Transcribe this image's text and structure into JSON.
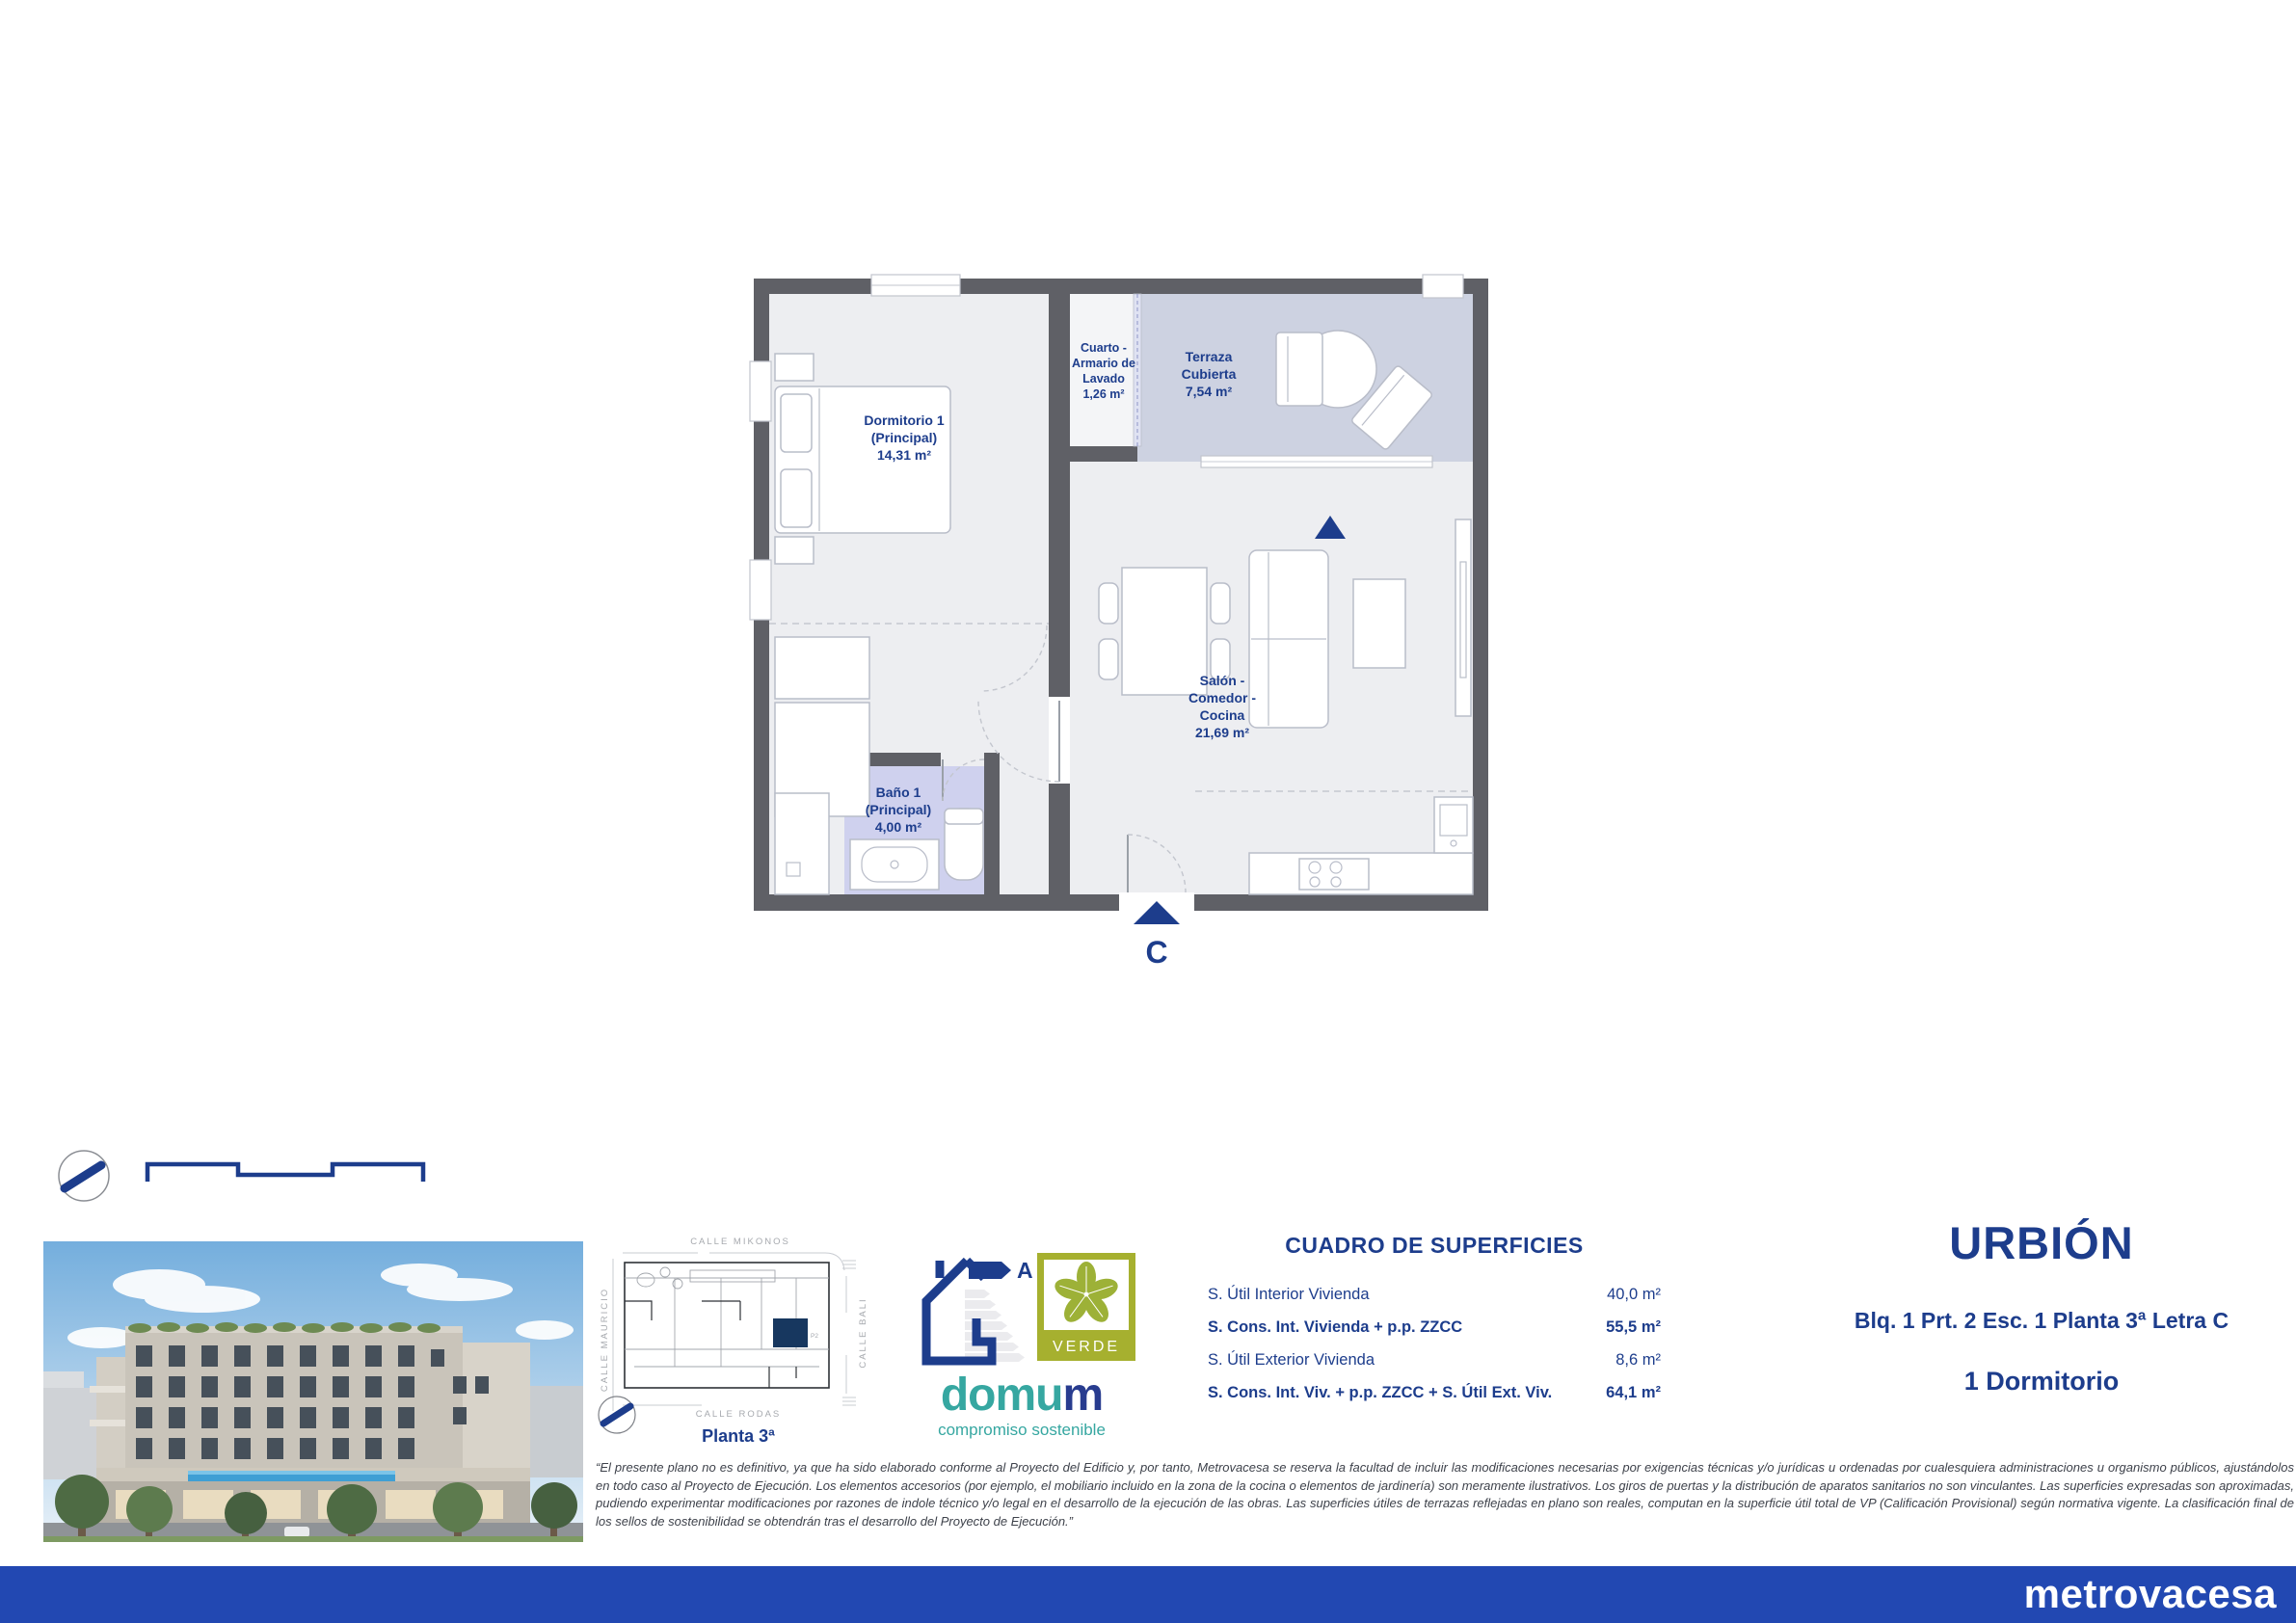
{
  "floor_plan": {
    "rooms": {
      "dormitorio": {
        "lines": [
          "Dormitorio 1",
          "(Principal)"
        ],
        "area": "14,31 m²"
      },
      "cuarto": {
        "lines": [
          "Cuarto -",
          "Armario de",
          "Lavado"
        ],
        "area": "1,26 m²"
      },
      "terraza": {
        "lines": [
          "Terraza",
          "Cubierta"
        ],
        "area": "7,54 m²"
      },
      "salon": {
        "lines": [
          "Salón -",
          "Comedor -",
          "Cocina"
        ],
        "area": "21,69 m²"
      },
      "bano": {
        "lines": [
          "Baño 1",
          "(Principal)"
        ],
        "area": "4,00 m²"
      }
    },
    "entrance_letter": "C"
  },
  "site_plan": {
    "streets": {
      "top": "CALLE MIKONOS",
      "left": "CALLE MAURICIO",
      "right": "CALLE BALI",
      "bottom": "CALLE RODAS"
    },
    "floor_label": "Planta 3ª",
    "unit_tag": "P2"
  },
  "energy": {
    "rating": "A"
  },
  "badges": {
    "verde": "VERDE",
    "domum_part1": "domu",
    "domum_part2": "m",
    "domum_tagline": "compromiso sostenible"
  },
  "surfaces": {
    "title": "CUADRO DE SUPERFICIES",
    "rows": [
      {
        "label": "S. Útil Interior Vivienda",
        "value": "40,0 m²"
      },
      {
        "label": "S. Cons. Int. Vivienda + p.p. ZZCC",
        "value": "55,5 m²"
      },
      {
        "label": "S. Útil Exterior Vivienda",
        "value": "8,6 m²"
      },
      {
        "label": "S. Cons. Int. Viv. + p.p. ZZCC + S. Útil Ext. Viv.",
        "value": "64,1 m²"
      }
    ]
  },
  "unit": {
    "project": "URBIÓN",
    "location": "Blq. 1 Prt. 2 Esc. 1 Planta 3ª Letra C",
    "type": "1 Dormitorio"
  },
  "disclaimer": "“El presente plano no es definitivo, ya que ha sido elaborado conforme al Proyecto del Edificio y, por tanto, Metrovacesa se reserva la facultad de incluir las modificaciones necesarias por exigencias técnicas y/o jurídicas u ordenadas por cualesquiera administraciones u organismo públicos, ajustándolos en todo caso al Proyecto de Ejecución. Los elementos accesorios (por ejemplo, el mobiliario incluido en la zona de la cocina o elementos de jardinería) son meramente ilustrativos. Los giros de puertas y la distribución de aparatos sanitarios no son vinculantes. Las superficies expresadas son aproximadas, pudiendo experimentar modificaciones por razones de indole técnico y/o legal en el desarrollo de la ejecución de las obras. Las superficies útiles de terrazas reflejadas en plano son reales, computan en la superficie útil total de VP (Calificación Provisional) según normativa vigente. La clasificación final de los sellos de sostenibilidad se obtendrán tras el desarrollo del Proyecto de Ejecución.”",
  "footer": {
    "brand": "metrovacesa"
  },
  "colors": {
    "navy": "#1d3d8c",
    "footer_blue": "#2248b2",
    "teal": "#36a7a1",
    "olive": "#a6b02f",
    "wall_gray": "#5f6066",
    "floor_gray": "#edeef1",
    "terrace_fill": "#cdd2e1",
    "bath_fill": "#cfd1ee"
  }
}
